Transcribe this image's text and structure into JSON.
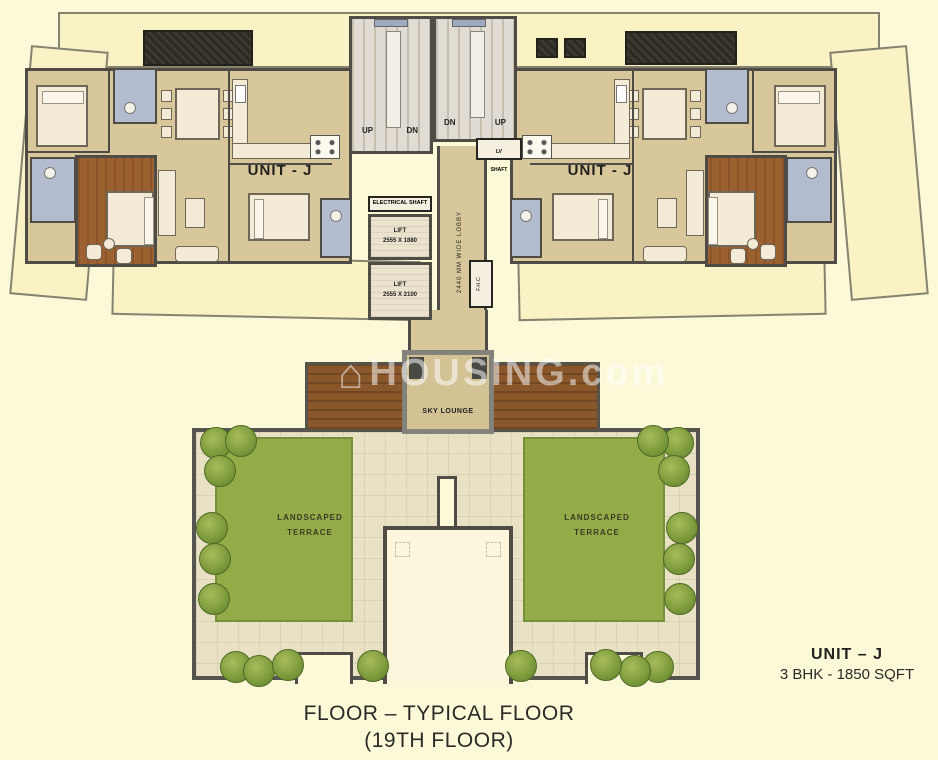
{
  "title": {
    "line1": "FLOOR – TYPICAL FLOOR",
    "line2": "(19TH FLOOR)"
  },
  "unit_summary": {
    "name": "UNIT – J",
    "spec": "3 BHK - 1850 SQFT"
  },
  "units": {
    "left_label": "UNIT - J",
    "right_label": "UNIT - J"
  },
  "core": {
    "electrical_shaft": "ELECTRICAL SHAFT",
    "lift_upper": "LIFT\n2555 X 1880",
    "lift_lower": "LIFT\n2555 X 2100",
    "lobby": "2440 MM WIDE LOBBY",
    "fhc": "F.H.C",
    "lv_shaft": "LV\nSHAFT",
    "stair_left_up": "UP",
    "stair_left_dn": "DN",
    "stair_right_dn": "DN",
    "stair_right_up": "UP"
  },
  "amenities": {
    "sky_lounge": "SKY LOUNGE",
    "terrace_left": "LANDSCAPED\nTERRACE",
    "terrace_right": "LANDSCAPED\nTERRACE"
  },
  "watermark": {
    "icon": "house-icon",
    "text": "HOUSING.com"
  },
  "colors": {
    "background": "#FCF9D8",
    "wall": "#4E4C45",
    "apartment_floor": "#D8C79B",
    "balcony": "#F8F2C4",
    "bathroom": "#B3BCCE",
    "master_wood": "#9C6130",
    "deck_wood": "#8A572B",
    "terrace_tile": "#E9E1C3",
    "lawn_green": "#94AC47",
    "stair": "#E0DCD3"
  }
}
